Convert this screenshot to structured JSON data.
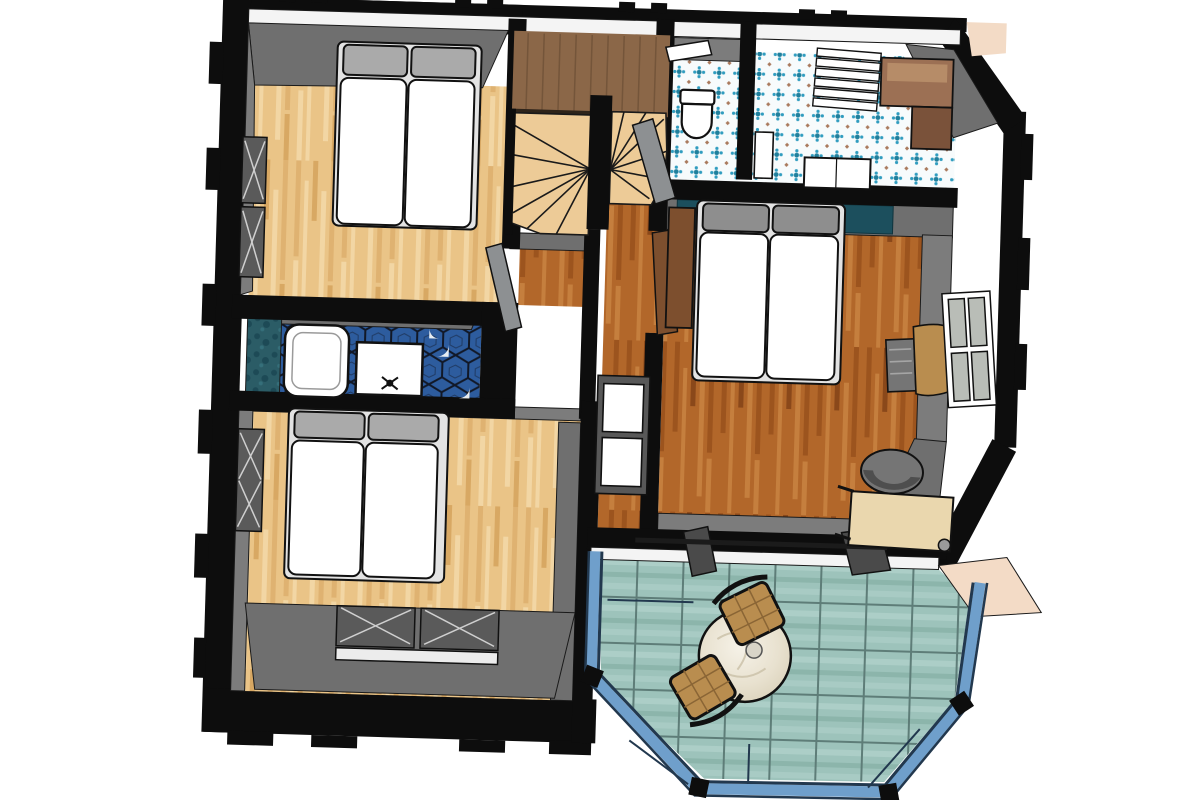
{
  "scene": {
    "kind": "3d-floor-plan-top-view",
    "description": "Overhead 3D rendering of an upper floor: two bedrooms with double beds (light wood floors), master bedroom with double bed, wardrobe, desk and office chair (orange wood floor), winder staircase with brown landing, WC with toilet, bathroom with patterned blue tile, vanity and towel radiator, small shower room with dark blue hex tile, tub and sink, and a glazed bay conservatory with teal tile floor, round marble table and two woven chairs."
  },
  "colors": {
    "bg": "#ffffff",
    "wall": "#0d0d0d",
    "wallFace": "#6f6f6f",
    "wallFaceMid": "#7c7c7c",
    "wallFaceLight": "#929292",
    "eave": "#f4f4f4",
    "sill": "#ececec",
    "peach": "#f3dbc6",
    "floorLight": "#eac487",
    "floorLightA": "#dfb271",
    "floorLightB": "#f2d6a4",
    "floorLightC": "#d8a863",
    "floorOrange": "#b2672a",
    "floorOrangeA": "#9c541e",
    "floorOrangeB": "#c57f3e",
    "floorOrangeC": "#8a481a",
    "landing": "#8b6748",
    "landingLine": "#74553a",
    "stepTan": "#edcb97",
    "tealWall": "#1c4f5d",
    "tileTeal": "#9dc3bb",
    "tileTealLight": "#afd0c9",
    "tileTealDark": "#88b1a8",
    "tileGrout": "#5e7d78",
    "blueTileBg": "#f7fbfc",
    "blueTileDot": "#2f9cbf",
    "blueTileDeep": "#1f7f9c",
    "blueTileAccent": "#a9795c",
    "hexBlue": "#2d5c9e",
    "hexLine": "#111827",
    "mottleTeal": "#2b5c66",
    "mottleTealDark": "#1d4a56",
    "bayFrame": "#6f9fcb",
    "bayFrameLight": "#a6c4e0",
    "bayFrameDark": "#22384e",
    "doorGray": "#8d9092",
    "doorBrown": "#7d4f2e",
    "white": "#ffffff",
    "pillow": "#aaaaaa",
    "pillowDark": "#8e8e8e",
    "deskWood": "#ead7ae",
    "chairGray": "#757575",
    "chairGrayDark": "#4e4e4e",
    "vanityBrown": "#9c7054",
    "vanityBrownDark": "#7a523a",
    "wovenTan": "#b98d4f",
    "marble": "#eae4d4",
    "marbleVein": "#c9bfa6",
    "glass": "#b9bdb7",
    "radiator": "#cfcfcf",
    "radiatorFrame": "#5a5a5a",
    "outline": "#1a1a1a"
  },
  "rooms": [
    {
      "name": "bedroom-top-left",
      "floor": "light wood planks",
      "furniture": [
        "double bed with two mattresses and pillows",
        "two wall radiator windows"
      ]
    },
    {
      "name": "stair-landing",
      "floor": "brown wood",
      "furniture": [
        "u-shaped winder staircase",
        "railing"
      ]
    },
    {
      "name": "wc",
      "floor": "blue patterned tile",
      "furniture": [
        "toilet",
        "door"
      ]
    },
    {
      "name": "bathroom-top-right",
      "floor": "blue patterned tile",
      "furniture": [
        "towel radiator",
        "corner vanity cabinet",
        "sink"
      ]
    },
    {
      "name": "shower-room-left",
      "floor": "dark blue hex tile",
      "furniture": [
        "tub",
        "sink vanity with faucet",
        "teal shower panel"
      ]
    },
    {
      "name": "bedroom-bottom-left",
      "floor": "light wood planks",
      "furniture": [
        "double bed",
        "two window radiators",
        "side radiator"
      ]
    },
    {
      "name": "hallway",
      "floor": "orange wood planks",
      "furniture": [
        "white shelving unit",
        "doors"
      ]
    },
    {
      "name": "master-bedroom",
      "floor": "orange wood planks",
      "furniture": [
        "double bed",
        "teal headboard wall",
        "wardrobe",
        "side chair and table",
        "desk",
        "office chair",
        "window"
      ]
    },
    {
      "name": "conservatory-patio",
      "floor": "teal ceramic tile",
      "furniture": [
        "round marble bistro table",
        "two woven chairs",
        "glazed bay window"
      ]
    }
  ]
}
